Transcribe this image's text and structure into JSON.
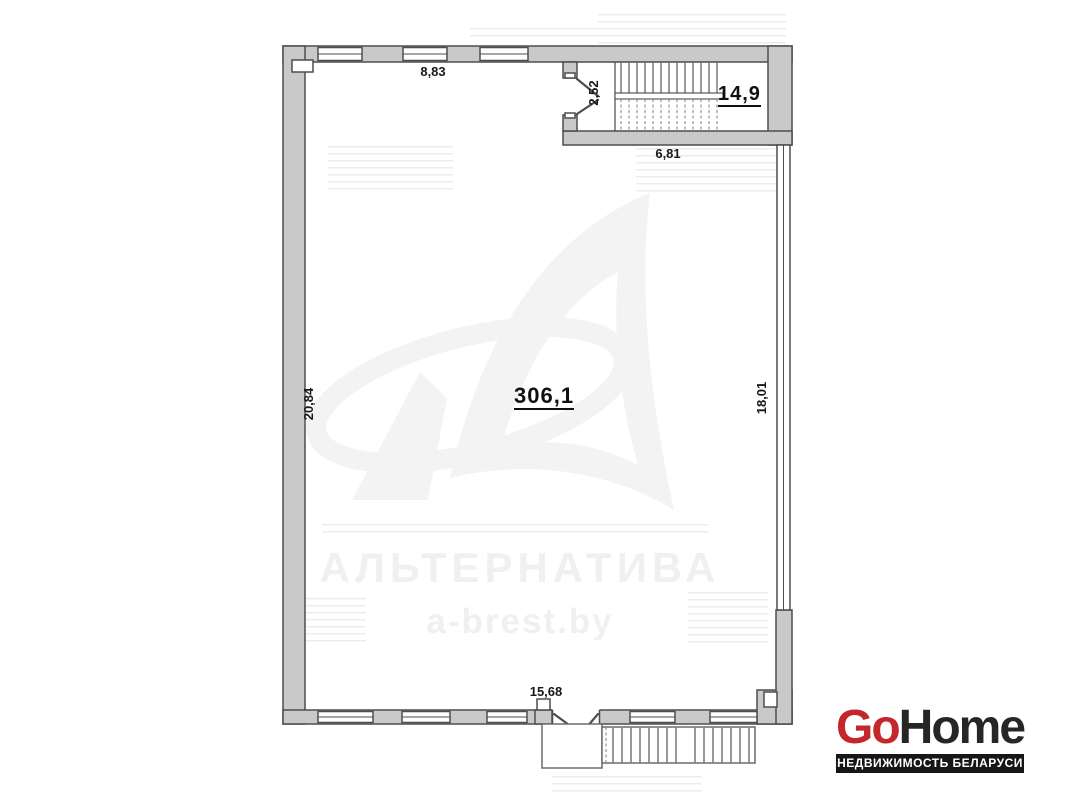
{
  "plan": {
    "main_room_area": "306,1",
    "stair_room_area": "14,9",
    "dim_top_wall": "8,83",
    "dim_stair_door": "2,52",
    "dim_under_stairs": "6,81",
    "dim_left_wall": "20,84",
    "dim_right_wall": "18,01",
    "dim_bottom_door": "15,68"
  },
  "watermark": {
    "agency": "АЛЬТЕРНАТИВА",
    "website": "a-brest.by"
  },
  "branding": {
    "logo_part1": "Go",
    "logo_part2": "Home",
    "tagline": "НЕДВИЖИМОСТЬ БЕЛАРУСИ",
    "logo_accent_color": "#c4272b",
    "wall_fill_color": "#c9c9c9"
  }
}
